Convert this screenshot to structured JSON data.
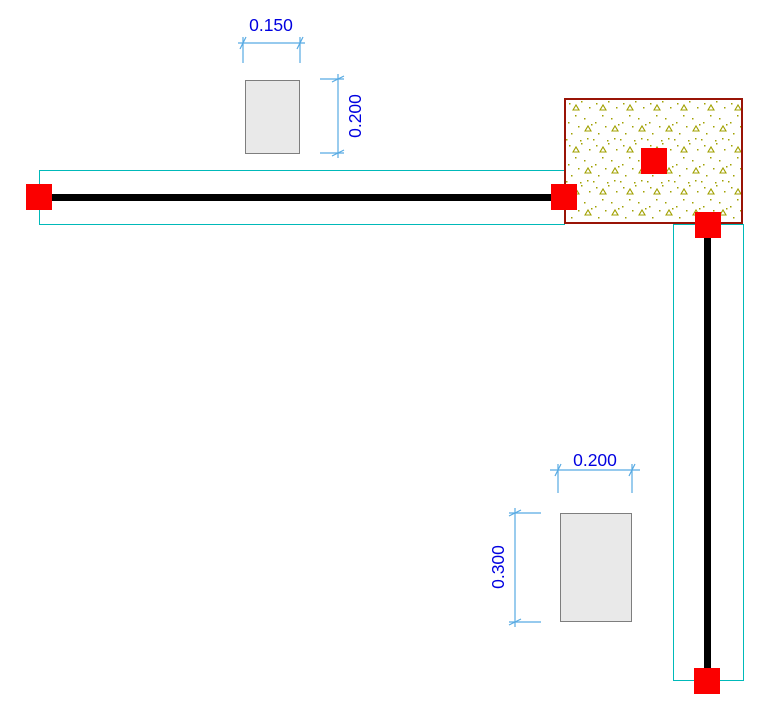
{
  "drawing": {
    "type": "cad-plan-view",
    "background": "#ffffff",
    "colors": {
      "dimension_text": "#0000e0",
      "dimension_line": "#57aae3",
      "beam_outline": "#00b9b9",
      "beam_axis": "#000000",
      "selection_handle": "#fb0000",
      "column_border": "#991407",
      "hatch_speckle": "#a0a000",
      "section_fill": "#e9e9e9",
      "section_border": "#7e7e7e"
    },
    "dimensions": {
      "top_section_width": {
        "label": "0.150"
      },
      "top_section_height": {
        "label": "0.200"
      },
      "bottom_section_width": {
        "label": "0.200"
      },
      "bottom_section_height": {
        "label": "0.300"
      }
    },
    "elements": {
      "horizontal_beam": "beam with axis line and cyan contour",
      "vertical_beam": "beam with axis line and cyan contour",
      "column": "rectangle with concrete hatch fill",
      "top_cross_section": "0.150 x 0.200 rectangle preview",
      "bottom_cross_section": "0.200 x 0.300 rectangle preview",
      "selection_handle_count": 5
    }
  }
}
